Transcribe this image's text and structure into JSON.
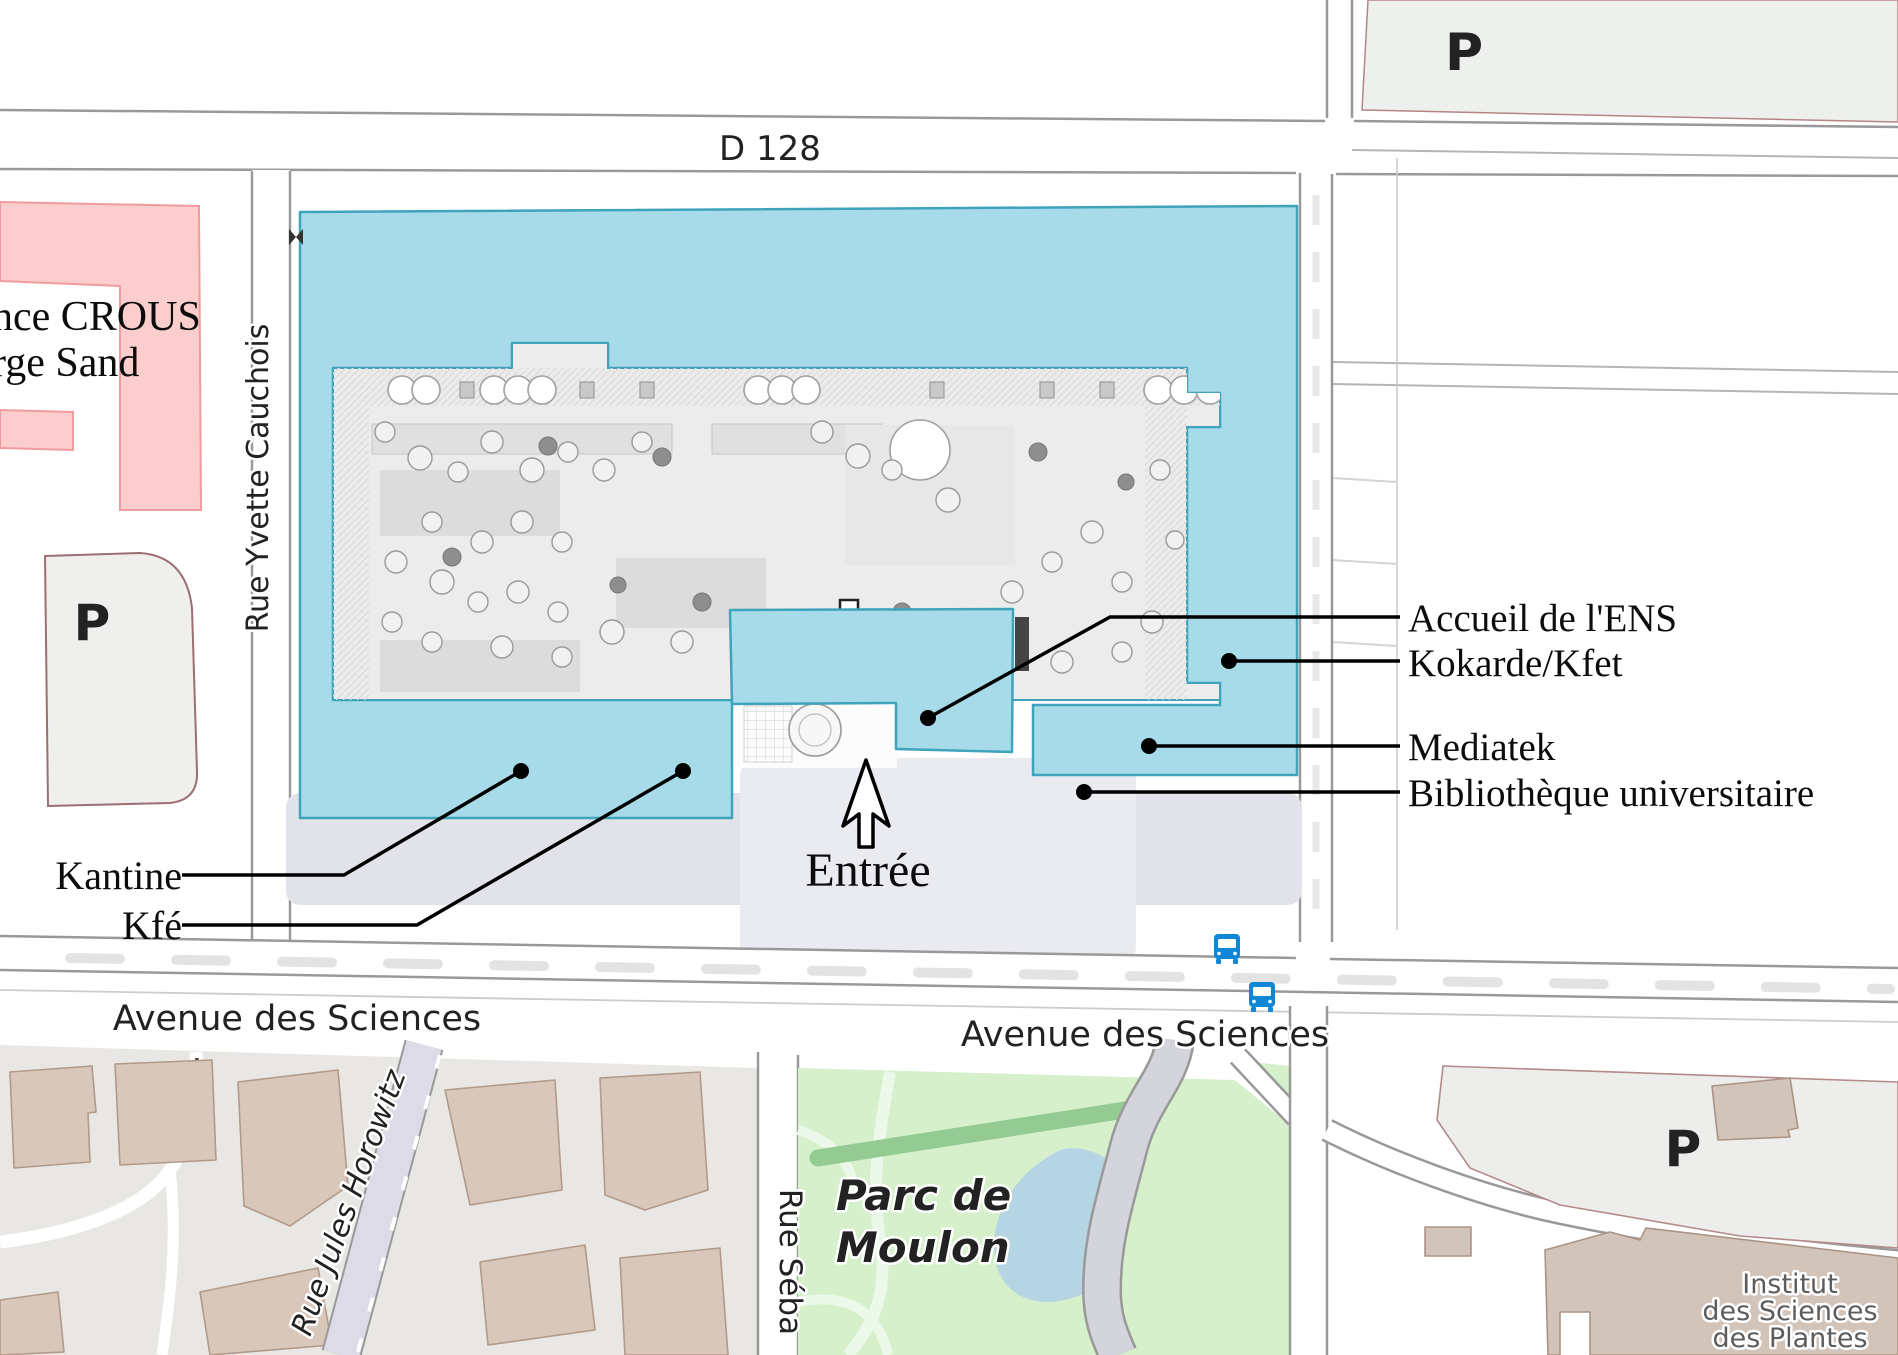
{
  "map": {
    "streets": {
      "d128": "D 128",
      "rue_yvette_cauchois": "Rue Yvette Cauchois",
      "avenue_des_sciences_west": "Avenue des Sciences",
      "avenue_des_sciences_east": "Avenue des Sciences",
      "rue_jules_horowitz": "Rue Jules Horowitz",
      "rue_sebastien_partial": "Rue Séba"
    },
    "places": {
      "crous_line1": "nce CROUS",
      "crous_line2": "rge Sand",
      "parc_line1": "Parc de",
      "parc_line2": "Moulon",
      "institut_line1": "Institut",
      "institut_line2": "des Sciences",
      "institut_line3": "des Plantes"
    },
    "parking_letter": "P",
    "callouts": {
      "accueil": "Accueil de l'ENS",
      "kokarde": "Kokarde/Kfet",
      "mediatek": "Mediatek",
      "bibliotheque": "Bibliothèque universitaire",
      "kantine": "Kantine",
      "kfe": "Kfé",
      "entree": "Entrée"
    },
    "colors": {
      "site_fill": "#a8dbe9",
      "site_border": "#3fa3bc",
      "parking_p_blue": "#1588d1",
      "parking_p_light_blue": "#9fd0ea",
      "crous_fill": "#fbcdcd",
      "crous_border": "#f09c9c",
      "park_fill": "#d5f0cb",
      "park_label_green": "#2e8b2e",
      "bus_blue": "#0f87d5",
      "building_tan": "#d8c7ba",
      "road_casing": "#999999"
    }
  }
}
